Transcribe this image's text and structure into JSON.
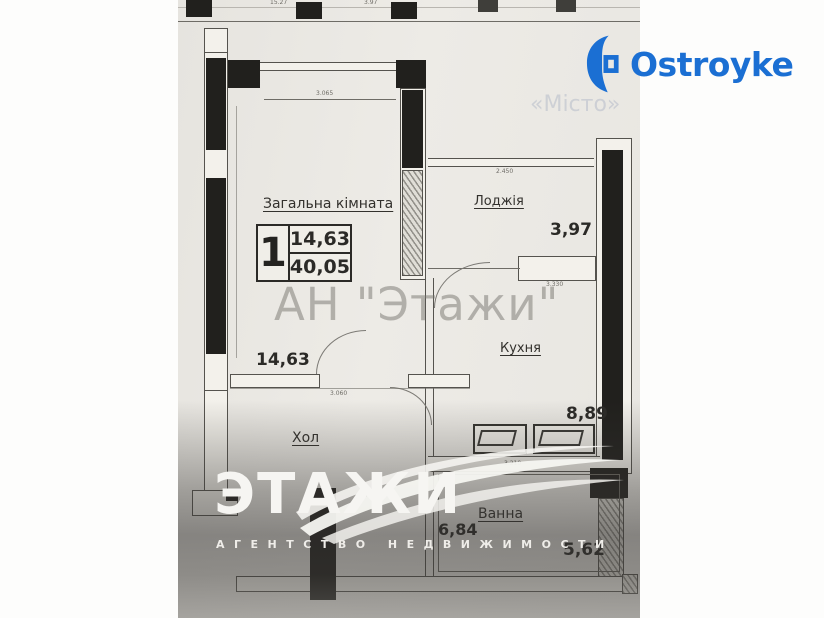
{
  "branding": {
    "logo_text": "Ostroyke"
  },
  "strip": {
    "dim1": "15.27",
    "dim2": "3.97"
  },
  "stamp": {
    "number": "1",
    "area_top": "14,63",
    "area_bottom": "40,05"
  },
  "rooms": {
    "living": {
      "name": "Загальна кімната",
      "area": "14,63"
    },
    "loggia": {
      "name": "Лоджія",
      "area": "3,97"
    },
    "kitchen": {
      "name": "Кухня",
      "area": "8,89"
    },
    "hall": {
      "name": "Хол",
      "area": "6,84"
    },
    "bath": {
      "name": "Ванна",
      "area": "5,62"
    }
  },
  "dims": {
    "living_width": "3.065",
    "loggia_width": "2.450",
    "kitchen_top": "3.330",
    "kitchen_bottom": "3.210",
    "hall_width": "3.060"
  },
  "watermarks": {
    "center": "АН \"Этажи\"",
    "faint": "«Місто»",
    "bottom_logo": "ЭТАЖИ",
    "bottom_subtitle": "АГЕНТСТВО НЕДВИЖИМОСТИ"
  }
}
